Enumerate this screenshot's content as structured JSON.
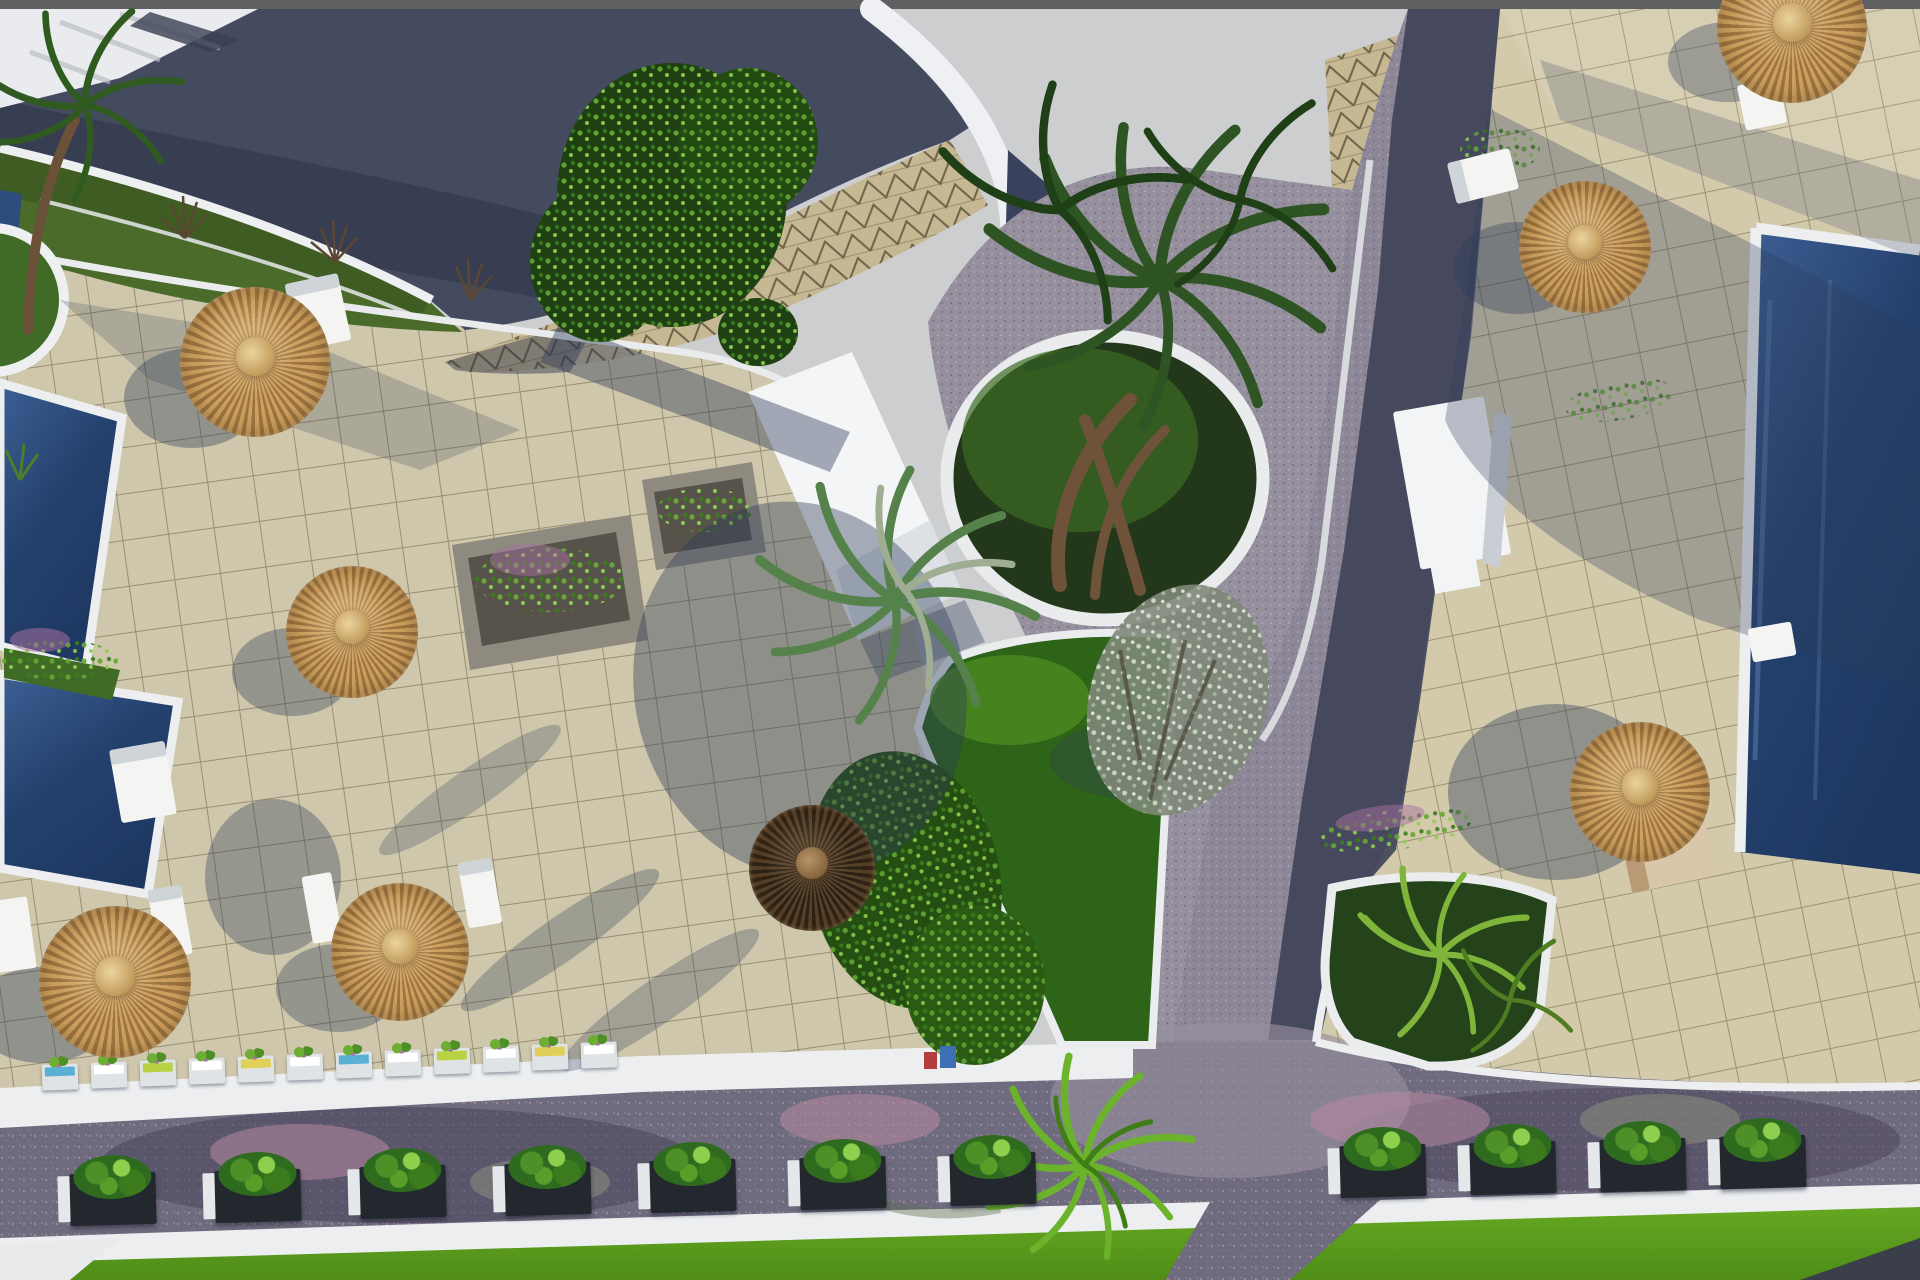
{
  "meta": {
    "title": "Aerial 3D architectural rendering of a resort complex with pools, tiled sun terraces, thatched parasols, palm trees and paved roads",
    "image_type": "architectural-visualization-render",
    "view": "top-down aerial"
  },
  "colors": {
    "sky": "#cdced0",
    "topbar": "#5f6062",
    "roofDark": "#454b5f",
    "roofShadow": "#363c50",
    "domeTile": "#c7b894",
    "domeLine": "#6f6349",
    "white": "#eef0f2",
    "tileLeft": "#cdc4a6",
    "tileRight": "#d3caac",
    "tileLine": "#7d7355",
    "roadDark": "#3e4358",
    "roadLit": "#908a9c",
    "roadBottom": "#6f6b7e",
    "poolDeep": "#1d3760",
    "poolLight": "#3d6094",
    "lawn": "#5ea21f",
    "gardenGrass": "#2e6418",
    "bushDark": "#2f6b1f",
    "bushLight": "#8ed04e",
    "thatchLight": "#cda05f",
    "thatchDark": "#9c7440",
    "thatchHub": "#c6a264",
    "shadow": "#2d3c58",
    "trunk": "#6e523a",
    "stone": "#8f8a80",
    "blossomPink": "#c793ad",
    "silverLeaf": "#aab4a0",
    "flowerPurple": "#a86fa0",
    "loungerWhite": "#f4f5f3",
    "loungerTan": "#d9c7a9",
    "accentBlue": "#58b0d2",
    "accentGreen": "#b9d244",
    "accentYellow": "#e0d05a",
    "planterDark": "#23272e"
  },
  "scene": {
    "umbrella_count": 8,
    "dark_umbrella_count": 1,
    "sun_lounger_count": 10,
    "pool_count": 4,
    "palm_tree_count": 7,
    "planter_box_colorful_count": 12,
    "planter_box_bush_count": 11,
    "elements": [
      "curved-clubhouse-roof",
      "triangle-tiled-dome",
      "white-parapet-walls",
      "upper-garden-strip",
      "large-green-tree",
      "left-sun-terrace",
      "right-sun-terrace",
      "left-pools",
      "right-edge-pool",
      "circular-palm-planter",
      "central-garden-bed",
      "corner-fern-garden",
      "diagonal-road",
      "lower-road",
      "road-junction",
      "white-footbridge",
      "white-pool-house",
      "stone-flower-planters",
      "thatched-parasols",
      "sun-loungers",
      "planter-box-rows",
      "bottom-lawn"
    ]
  }
}
